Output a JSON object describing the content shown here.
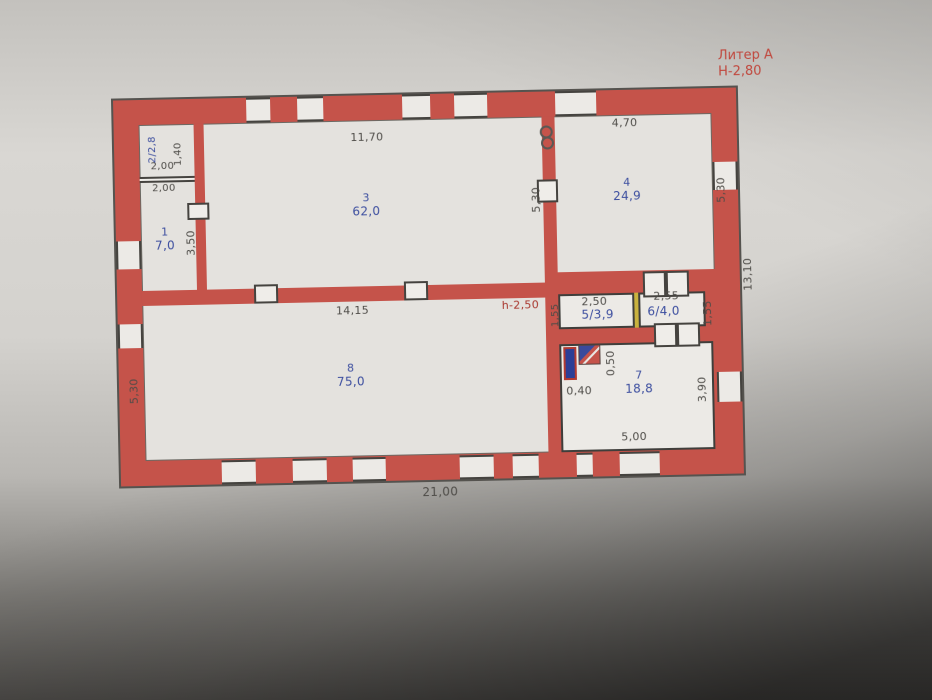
{
  "annotations": {
    "liter": "Литер А",
    "building_height": "Н-2,80",
    "ceiling_height": "h-2,50"
  },
  "rooms": {
    "r1": {
      "num": "1",
      "area": "7,0"
    },
    "r2": {
      "label": "2/2,8"
    },
    "r3": {
      "num": "3",
      "area": "62,0"
    },
    "r4": {
      "num": "4",
      "area": "24,9"
    },
    "r5": {
      "label": "5/3,9"
    },
    "r6": {
      "label": "6/4,0"
    },
    "r7": {
      "num": "7",
      "area": "18,8"
    },
    "r8": {
      "num": "8",
      "area": "75,0"
    }
  },
  "dims": {
    "top_room3": "11,70",
    "top_room4": "4,70",
    "room2_width_a": "2,00",
    "room2_width_b": "2,00",
    "room2_height": "1,40",
    "room1_height": "3,50",
    "wall34": "5,30",
    "right_top": "5,30",
    "left_bottom": "5,30",
    "right_total": "13,10",
    "room8_top": "14,15",
    "room5_top": "2,50",
    "room6_top": "2,55",
    "room5_left": "1,55",
    "room6_right": "1,55",
    "room7_a": "0,40",
    "room7_b": "0,50",
    "room7_bottom": "5,00",
    "room7_right": "3,90",
    "bottom_total": "21,00"
  },
  "colors": {
    "wall": "#c5534a",
    "paper": "#e4e2de",
    "blue_text": "#3c4e9f",
    "red_text": "#c0473d",
    "dim_text": "#4e4c48",
    "divider_yellow": "#c9b23e"
  }
}
